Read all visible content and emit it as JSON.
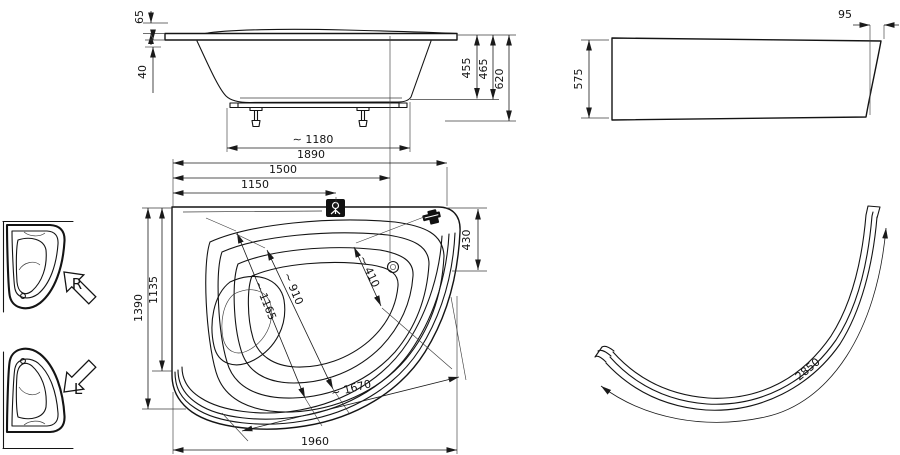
{
  "dims": {
    "side": {
      "rim_height": "65",
      "rim_drop": "40",
      "inner_depth": "455",
      "shell_height": "465",
      "total_height": "620",
      "feet_span": "∼ 1180"
    },
    "front_panel": {
      "height": "575",
      "curve_depth": "95"
    },
    "plan": {
      "total_width": "1890",
      "width_to_drain": "1500",
      "width_to_faucet": "1150",
      "side_total": "1390",
      "side_inner": "1135",
      "right_edge": "430",
      "diag_drain": "∼ 410",
      "diag_mid": "∼ 910",
      "diag_long": "∼ 1165",
      "curve_edge": "∼ 1670",
      "bottom_total": "1960"
    },
    "panel_plan": {
      "arc_length": "2850"
    }
  },
  "orientation": {
    "right": "R",
    "left": "L"
  }
}
